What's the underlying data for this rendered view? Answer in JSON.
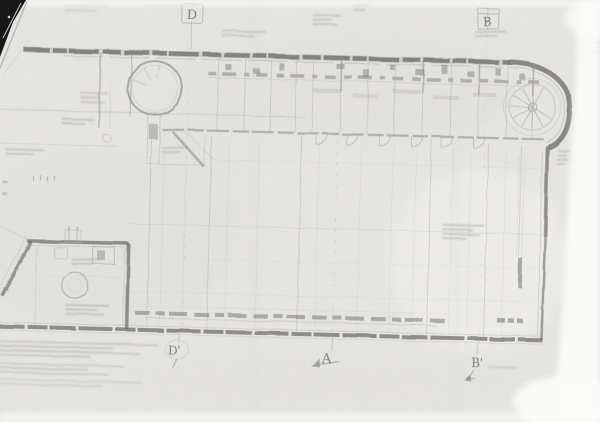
{
  "scan": {
    "section_markers": {
      "top_left": "D",
      "top_right": "B",
      "bottom_left": "D'",
      "bottom_center": "A",
      "bottom_right": "B'"
    },
    "colors": {
      "paper": "#e9e8e4",
      "page_background": "#fdfdfc",
      "ink_dark": "#6b6a66",
      "ink_medium": "#8f8e8a",
      "ink_light": "#b3b2ae",
      "corner_shadow": "#171717"
    }
  }
}
